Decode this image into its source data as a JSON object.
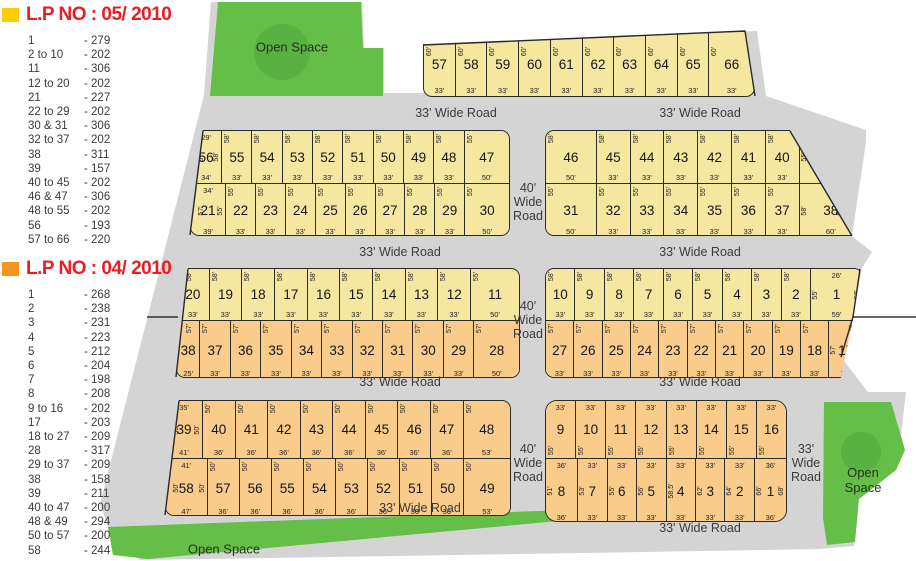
{
  "legends": [
    {
      "title": "L.P NO : 05/ 2010",
      "swatch": "#FFCC00",
      "entries": [
        [
          "1",
          "279"
        ],
        [
          "2 to 10",
          "202"
        ],
        [
          "11",
          "306"
        ],
        [
          "12 to 20",
          "202"
        ],
        [
          "21",
          "227"
        ],
        [
          "22 to 29",
          "202"
        ],
        [
          "30 & 31",
          "306"
        ],
        [
          "32 to 37",
          "202"
        ],
        [
          "38",
          "311"
        ],
        [
          "39",
          "157"
        ],
        [
          "40 to 45",
          "202"
        ],
        [
          "46 & 47",
          "306"
        ],
        [
          "48 to 55",
          "202"
        ],
        [
          "56",
          "193"
        ],
        [
          "57 to 66",
          "220"
        ]
      ]
    },
    {
      "title": "L.P NO : 04/ 2010",
      "swatch": "#F7941D",
      "entries": [
        [
          "1",
          "268"
        ],
        [
          "2",
          "238"
        ],
        [
          "3",
          "231"
        ],
        [
          "4",
          "223"
        ],
        [
          "5",
          "212"
        ],
        [
          "6",
          "204"
        ],
        [
          "7",
          "198"
        ],
        [
          "8",
          "208"
        ],
        [
          "9 to 16",
          "202"
        ],
        [
          "17",
          "203"
        ],
        [
          "18 to 27",
          "209"
        ],
        [
          "28",
          "317"
        ],
        [
          "29 to 37",
          "209"
        ],
        [
          "38",
          "158"
        ],
        [
          "39",
          "211"
        ],
        [
          "40 to 47",
          "200"
        ],
        [
          "48 & 49",
          "294"
        ],
        [
          "50 to 57",
          "200"
        ],
        [
          "58",
          "244"
        ]
      ]
    }
  ],
  "map": {
    "open_space_label": "Open Space",
    "road_labels": {
      "h33": "33' Wide Road",
      "v40": "40'\nWide\nRoad",
      "v33": "33'\nWide\nRoad"
    },
    "colors": {
      "lp05_fill": "#F5E6A0",
      "lp04_fill": "#FACC8C",
      "road": "#D4D4D4",
      "green": "#64BE47",
      "green_dark": "#4EA63B"
    },
    "blocks": {
      "row1": [
        {
          "n": "57",
          "d": "60'",
          "b": "33'"
        },
        {
          "n": "58",
          "d": "60'",
          "b": "33'"
        },
        {
          "n": "59",
          "d": "60'",
          "b": "33'"
        },
        {
          "n": "60",
          "d": "60'",
          "b": "33'"
        },
        {
          "n": "61",
          "d": "60'",
          "b": "33'"
        },
        {
          "n": "62",
          "d": "60'",
          "b": "33'"
        },
        {
          "n": "63",
          "d": "60'",
          "b": "33'"
        },
        {
          "n": "64",
          "d": "60'",
          "b": "33'"
        },
        {
          "n": "65",
          "d": "60'",
          "b": "33'"
        },
        {
          "n": "66",
          "d": "60'",
          "b": "33'",
          "f": 1.45
        }
      ],
      "row2l_top": [
        {
          "n": "56",
          "t": "29'",
          "l": "57'",
          "r": "58'",
          "b": "34'"
        },
        {
          "n": "55",
          "d": "58'",
          "b": "33'"
        },
        {
          "n": "54",
          "d": "58'",
          "b": "33'"
        },
        {
          "n": "53",
          "d": "58'",
          "b": "33'"
        },
        {
          "n": "52",
          "d": "58'",
          "b": "33'"
        },
        {
          "n": "51",
          "d": "58'",
          "b": "33'"
        },
        {
          "n": "50",
          "d": "58'",
          "b": "33'"
        },
        {
          "n": "49",
          "d": "58'",
          "b": "33'"
        },
        {
          "n": "48",
          "d": "58'",
          "b": "33'"
        },
        {
          "n": "47",
          "d": "55'",
          "b": "50'"
        }
      ],
      "row2l_bot": [
        {
          "n": "21",
          "t": "34'",
          "l": "57'",
          "r": "55'",
          "b": "39'"
        },
        {
          "n": "22",
          "d": "55'",
          "b": "33'"
        },
        {
          "n": "23",
          "d": "55'",
          "b": "33'"
        },
        {
          "n": "24",
          "d": "55'",
          "b": "33'"
        },
        {
          "n": "25",
          "d": "55'",
          "b": "33'"
        },
        {
          "n": "26",
          "d": "55'",
          "b": "33'"
        },
        {
          "n": "27",
          "d": "55'",
          "b": "33'"
        },
        {
          "n": "28",
          "d": "55'",
          "b": "33'"
        },
        {
          "n": "29",
          "d": "55'",
          "b": "33'"
        },
        {
          "n": "30",
          "d": "55'",
          "b": "50'"
        }
      ],
      "row2r_top": [
        {
          "n": "46",
          "d": "58'",
          "b": "50'"
        },
        {
          "n": "45",
          "d": "58'",
          "b": "33'"
        },
        {
          "n": "44",
          "d": "58'",
          "b": "33'"
        },
        {
          "n": "43",
          "d": "58'",
          "b": "33'"
        },
        {
          "n": "42",
          "d": "58'",
          "b": "33'"
        },
        {
          "n": "41",
          "d": "58'",
          "b": "33'"
        },
        {
          "n": "40",
          "d": "58'",
          "b": "33'"
        },
        {
          "n": "39",
          "t": "6'",
          "l": "55'",
          "r": "58'",
          "b": "41'",
          "f": 1.9,
          "cls": "c39"
        }
      ],
      "row2r_bot": [
        {
          "n": "31",
          "d": "55'",
          "b": "50'"
        },
        {
          "n": "32",
          "d": "55'",
          "b": "33'"
        },
        {
          "n": "33",
          "d": "55'",
          "b": "33'"
        },
        {
          "n": "34",
          "d": "55'",
          "b": "33'"
        },
        {
          "n": "35",
          "d": "55'",
          "b": "33'"
        },
        {
          "n": "36",
          "d": "55'",
          "b": "33'"
        },
        {
          "n": "37",
          "d": "55'",
          "b": "33'"
        },
        {
          "n": "38",
          "t": "41'",
          "l": "58'",
          "r": "58'",
          "b": "60'",
          "f": 1.9,
          "cls": "c38"
        }
      ],
      "row3l_top": [
        {
          "n": "20",
          "d": "58'",
          "b": "33'"
        },
        {
          "n": "19",
          "d": "58'",
          "b": "33'"
        },
        {
          "n": "18",
          "d": "58'",
          "b": "33'"
        },
        {
          "n": "17",
          "d": "58'",
          "b": "33'"
        },
        {
          "n": "16",
          "d": "58'",
          "b": "33'"
        },
        {
          "n": "15",
          "d": "58'",
          "b": "33'"
        },
        {
          "n": "14",
          "d": "58'",
          "b": "33'"
        },
        {
          "n": "13",
          "d": "58'",
          "b": "33'"
        },
        {
          "n": "12",
          "d": "58'",
          "b": "33'"
        },
        {
          "n": "11",
          "d": "55'",
          "b": "50'"
        }
      ],
      "row3l_bot": [
        {
          "n": "38",
          "d": "57'",
          "b": "25'"
        },
        {
          "n": "37",
          "d": "57'",
          "b": "33'"
        },
        {
          "n": "36",
          "d": "57'",
          "b": "33'"
        },
        {
          "n": "35",
          "d": "57'",
          "b": "33'"
        },
        {
          "n": "34",
          "d": "57'",
          "b": "33'"
        },
        {
          "n": "33",
          "d": "57'",
          "b": "33'"
        },
        {
          "n": "32",
          "d": "57'",
          "b": "33'"
        },
        {
          "n": "31",
          "d": "57'",
          "b": "33'"
        },
        {
          "n": "30",
          "d": "57'",
          "b": "33'"
        },
        {
          "n": "29",
          "d": "57'",
          "b": "33'"
        },
        {
          "n": "28",
          "d": "57'",
          "b": "50'"
        }
      ],
      "row3r_top": [
        {
          "n": "10",
          "d": "58'",
          "b": "33'"
        },
        {
          "n": "9",
          "d": "58'",
          "b": "33'"
        },
        {
          "n": "8",
          "d": "58'",
          "b": "33'"
        },
        {
          "n": "7",
          "d": "58'",
          "b": "33'"
        },
        {
          "n": "6",
          "d": "58'",
          "b": "33'"
        },
        {
          "n": "5",
          "d": "58'",
          "b": "33'"
        },
        {
          "n": "4",
          "d": "58'",
          "b": "33'"
        },
        {
          "n": "3",
          "d": "58'",
          "b": "33'"
        },
        {
          "n": "2",
          "d": "58'",
          "b": "33'"
        },
        {
          "n": "1",
          "t": "26'",
          "l": "55'",
          "r": "63'",
          "b": "59'"
        }
      ],
      "row3r_bot": [
        {
          "n": "27",
          "d": "57'",
          "b": "33'"
        },
        {
          "n": "26",
          "d": "57'",
          "b": "33'"
        },
        {
          "n": "25",
          "d": "57'",
          "b": "33'"
        },
        {
          "n": "24",
          "d": "57'",
          "b": "33'"
        },
        {
          "n": "23",
          "d": "57'",
          "b": "33'"
        },
        {
          "n": "22",
          "d": "57'",
          "b": "33'"
        },
        {
          "n": "21",
          "d": "57'",
          "b": "33'"
        },
        {
          "n": "20",
          "d": "57'",
          "b": "33'"
        },
        {
          "n": "19",
          "d": "57'",
          "b": "33'"
        },
        {
          "n": "18",
          "d": "57'",
          "b": "33'"
        },
        {
          "n": "17",
          "t": "25'",
          "l": "57'",
          "r": "57'",
          "b": "39'",
          "f": 1.2,
          "cls": "c17"
        }
      ],
      "row4l_top": [
        {
          "n": "39",
          "t": "35'",
          "l": "50'",
          "r": "50'",
          "b": "41'"
        },
        {
          "n": "40",
          "d": "50'",
          "b": "36'"
        },
        {
          "n": "41",
          "d": "50'",
          "b": "36'"
        },
        {
          "n": "42",
          "d": "50'",
          "b": "36'"
        },
        {
          "n": "43",
          "d": "50'",
          "b": "36'"
        },
        {
          "n": "44",
          "d": "50'",
          "b": "36'"
        },
        {
          "n": "45",
          "d": "50'",
          "b": "36'"
        },
        {
          "n": "46",
          "d": "50'",
          "b": "36'"
        },
        {
          "n": "47",
          "d": "50'",
          "b": "36'"
        },
        {
          "n": "48",
          "d": "50'",
          "b": "53'"
        }
      ],
      "row4l_bot": [
        {
          "n": "58",
          "t": "41'",
          "l": "50'",
          "r": "50'",
          "b": "47'"
        },
        {
          "n": "57",
          "d": "50'",
          "b": "36'"
        },
        {
          "n": "56",
          "d": "50'",
          "b": "36'"
        },
        {
          "n": "55",
          "d": "50'",
          "b": "36'"
        },
        {
          "n": "54",
          "d": "50'",
          "b": "36'"
        },
        {
          "n": "53",
          "d": "50'",
          "b": "36'"
        },
        {
          "n": "52",
          "d": "50'",
          "b": "36'"
        },
        {
          "n": "51",
          "d": "50'",
          "b": "36'"
        },
        {
          "n": "50",
          "d": "50'",
          "b": "36'"
        },
        {
          "n": "49",
          "d": "50'",
          "b": "53'"
        }
      ],
      "row4r_top": [
        {
          "n": "9",
          "t": "33'",
          "dl": "55'"
        },
        {
          "n": "10",
          "t": "33'",
          "dl": "55'"
        },
        {
          "n": "11",
          "t": "33'",
          "dl": "55'"
        },
        {
          "n": "12",
          "t": "33'",
          "dl": "55'"
        },
        {
          "n": "13",
          "t": "33'",
          "dl": "55'"
        },
        {
          "n": "14",
          "t": "33'",
          "dl": "55'"
        },
        {
          "n": "15",
          "t": "33'",
          "dl": "55'"
        },
        {
          "n": "16",
          "t": "33'",
          "dl": "55'"
        }
      ],
      "row4r_bot": [
        {
          "n": "8",
          "t": "36'",
          "l": "51'",
          "b": "36'"
        },
        {
          "n": "7",
          "t": "33'",
          "l": "53'",
          "b": "33'"
        },
        {
          "n": "6",
          "t": "33'",
          "l": "55'",
          "b": "33'"
        },
        {
          "n": "5",
          "t": "33'",
          "l": "56'",
          "b": "33'"
        },
        {
          "n": "4",
          "t": "33'",
          "l": "58.5'",
          "b": "33'"
        },
        {
          "n": "3",
          "t": "33'",
          "l": "62'",
          "b": "33'"
        },
        {
          "n": "2",
          "t": "33'",
          "l": "64'",
          "b": "33'"
        },
        {
          "n": "1",
          "t": "36'",
          "l": "66'",
          "r": "68'",
          "b": "36'"
        }
      ]
    }
  }
}
